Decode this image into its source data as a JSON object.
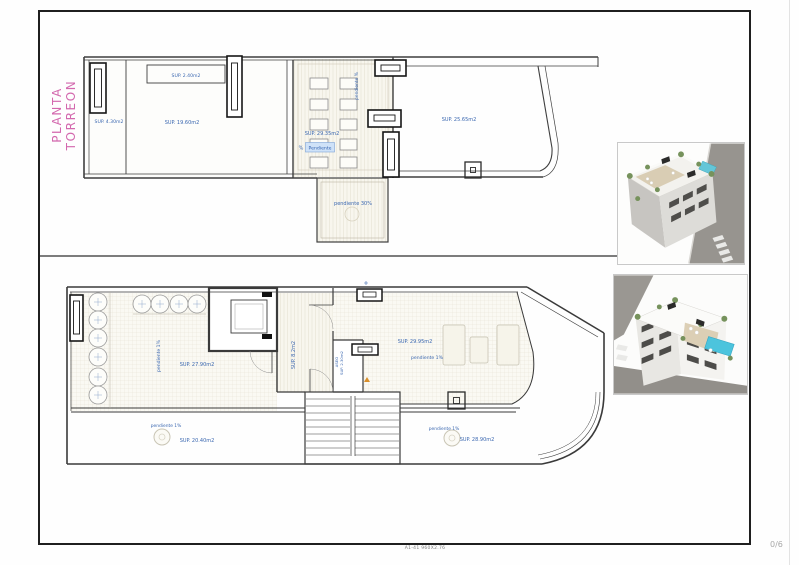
{
  "sheet": {
    "title": "PLANTA TORREON",
    "footer_note": "A1-41 960X2.76",
    "page_indicator": "0/6"
  },
  "upper_plan": {
    "labels": {
      "left_room": "SUP. 4.30m2",
      "roof_strip": "SUP. 2.40m2",
      "center_room": "SUP. 19.60m2",
      "panel_area": "SUP. 29.35m2",
      "slope_vertical": "pendiente %",
      "slope_tag_symbol": "%",
      "slope_tag": "Pendiente",
      "right_terrace": "SUP. 25.65m2",
      "lower_roof_slope": "pendiente 30%"
    }
  },
  "lower_plan": {
    "labels": {
      "left_terrace_slope": "pendiente 1%",
      "left_terrace": "SUP. 27.90m2",
      "hall": "SUP. 8.2m2",
      "wc_name": "ASEO",
      "wc_area": "SUP. 2.30m2",
      "right_terrace": "SUP. 29.95m2",
      "right_terrace_slope": "pendiente 1%",
      "front_left_terrace_slope": "pendiente 1%",
      "front_left_terrace": "SUP. 20.40m2",
      "front_right_terrace_slope": "pendiente 1%",
      "front_right_terrace": "SUP. 28.90m2"
    }
  },
  "colors": {
    "label_blue": "#3a67b0",
    "title_pink": "#d368ae",
    "wall_dark": "#3f3f3f",
    "highlight_fill": "#cfe2f8"
  }
}
